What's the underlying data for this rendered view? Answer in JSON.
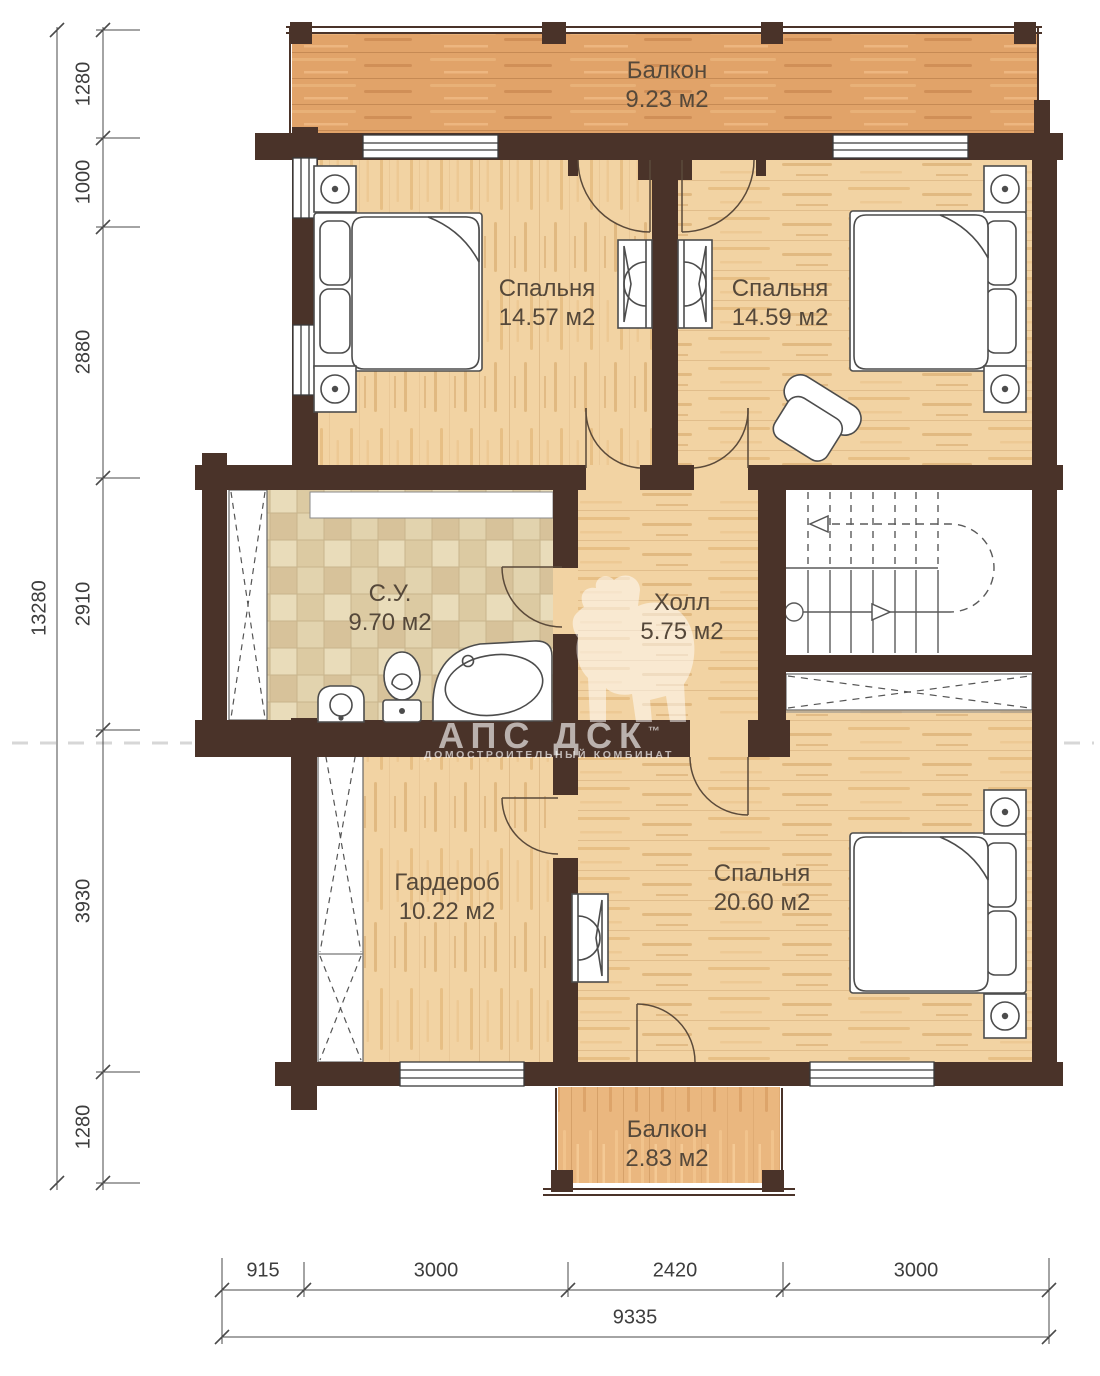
{
  "plan": {
    "rooms": [
      {
        "name": "Балкон",
        "area": "9.23 м2"
      },
      {
        "name": "Спальня",
        "area": "14.57 м2"
      },
      {
        "name": "Спальня",
        "area": "14.59 м2"
      },
      {
        "name": "С.У.",
        "area": "9.70 м2"
      },
      {
        "name": "Холл",
        "area": "5.75 м2"
      },
      {
        "name": "Гардероб",
        "area": "10.22 м2"
      },
      {
        "name": "Спальня",
        "area": "20.60 м2"
      },
      {
        "name": "Балкон",
        "area": "2.83 м2"
      }
    ],
    "dimensions": {
      "left_total": "13280",
      "left_segments": [
        "1280",
        "1000",
        "2880",
        "2910",
        "3930",
        "1280"
      ],
      "bottom_segments": [
        "915",
        "3000",
        "2420",
        "3000"
      ],
      "bottom_total": "9335"
    },
    "watermark": {
      "logo": "АПС ДСК",
      "tm": "™",
      "subtitle": "ДОМОСТРОИТЕЛЬНЫЙ КОМБИНАТ"
    },
    "colors": {
      "wall": "#4a3329",
      "wood_floor": "#f2d3a3",
      "balcony_top_floor": "#e1a369",
      "balcony_bottom_floor": "#eab77f",
      "tile_floor": "#e4d5b0",
      "label_text": "#55483a",
      "dimension_text": "#3d3d3d"
    }
  }
}
